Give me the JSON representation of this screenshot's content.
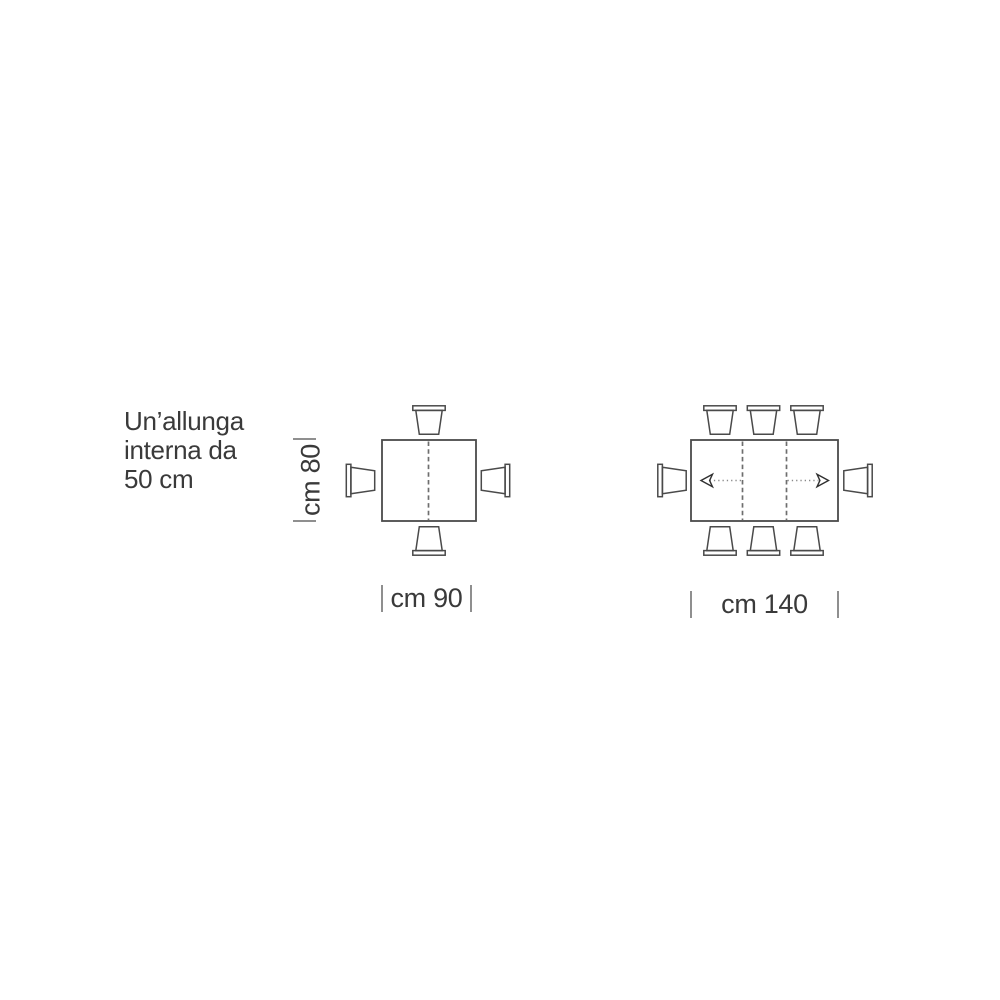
{
  "figure": {
    "note": {
      "line1": "Un’allunga",
      "line2": "interna da",
      "line3": "50 cm",
      "full_text": "Un’allunga interna da 50 cm"
    },
    "closed_table": {
      "width_label": "cm 90",
      "depth_label": "cm 80",
      "chair_count": 4,
      "leaf_dashed_lines": 1
    },
    "extended_table": {
      "width_label": "cm 140",
      "chair_count": 8,
      "leaf_dashed_lines": 2,
      "extension_arrow_directions": [
        "left",
        "right"
      ]
    },
    "colors": {
      "background": "#ffffff",
      "outline": "#4a4a4a",
      "text": "#3a3a3a",
      "dimension_tick": "#8f8f8f",
      "dashed_leaf_line": "#6e6e6e",
      "arrow_shaft": "#8a8a8a",
      "arrow_head": "#303030"
    }
  }
}
